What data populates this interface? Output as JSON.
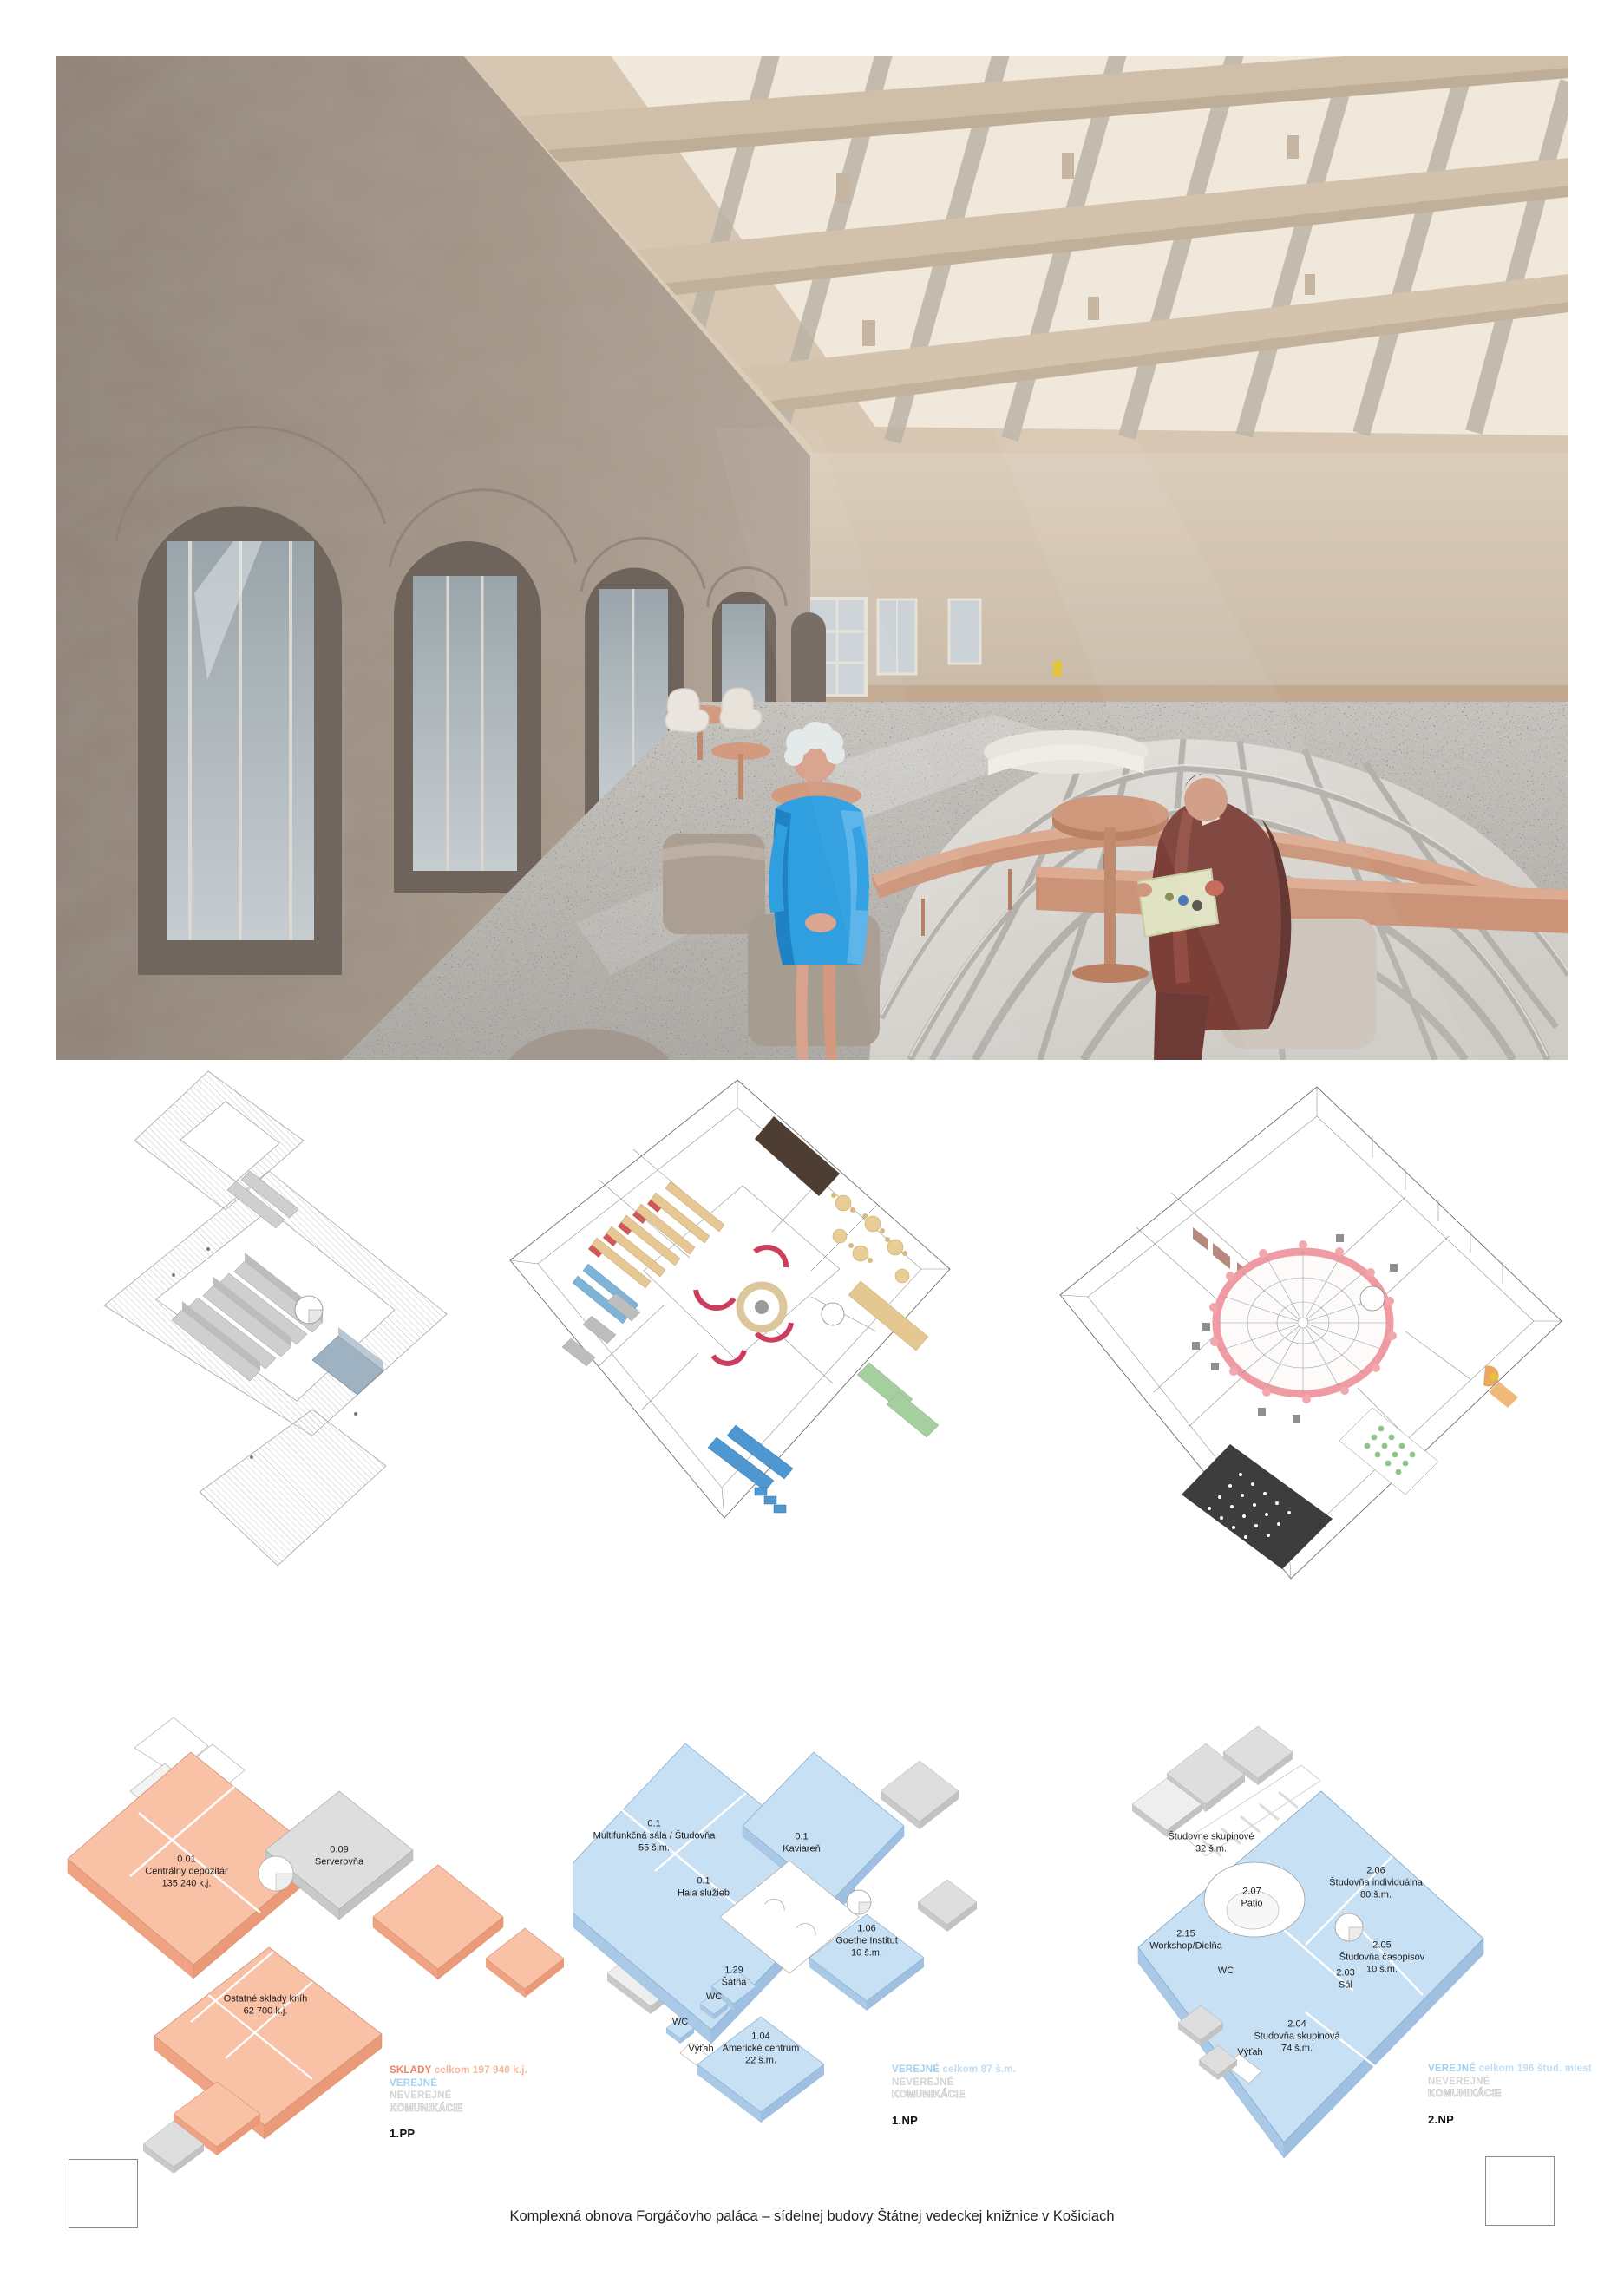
{
  "board": {
    "caption": "Komplexná obnova Forgáčovho paláca – sídelnej budovy Štátnej vedeckej knižnice v Košiciach"
  },
  "colors": {
    "storage_fill": "#f9c2a7",
    "storage_side": "#f0a382",
    "storage_text": "#ef8160",
    "public_fill": "#c8e0f4",
    "public_side": "#a9c9e6",
    "public_text": "#a5d0ee",
    "nonpublic_fill": "#dedede",
    "nonpublic_side": "#c9c9c9",
    "nonpublic_text": "#d4d4d4",
    "circulation_text": "#ffffff",
    "bench_accent": "#d39c82",
    "dome_ring_pink": "#ee9ba4"
  },
  "plans": {
    "pp1": {
      "floor": "1.PP",
      "legend": {
        "storage": "SKLADY",
        "storage_total": "celkom 197 940 k.j.",
        "public": "VEREJNÉ",
        "nonpublic": "NEVEREJNÉ",
        "circulation": "KOMUNIKÁCIE"
      },
      "rooms": {
        "depozitar": {
          "code": "0.01",
          "name": "Centrálny depozitár",
          "area": "135 240 k.j."
        },
        "serverovna": {
          "code": "0.09",
          "name": "Serverovňa"
        },
        "sklady": {
          "name": "Ostatné sklady kníh",
          "area": "62 700 k.j."
        }
      }
    },
    "np1": {
      "floor": "1.NP",
      "legend": {
        "public": "VEREJNÉ",
        "public_total": "celkom 87 š.m.",
        "nonpublic": "NEVEREJNÉ",
        "circulation": "KOMUNIKÁCIE"
      },
      "rooms": {
        "multifunkcna": {
          "code": "0.1",
          "name": "Multifunkčná sála / Študovňa",
          "area": "55 š.m."
        },
        "kaviaren": {
          "code": "0.1",
          "name": "Kaviareň"
        },
        "hala": {
          "code": "0.1",
          "name": "Hala služieb"
        },
        "goethe": {
          "code": "1.06",
          "name": "Goethe Institut",
          "area": "10 š.m."
        },
        "satna": {
          "code": "1.29",
          "name": "Šatňa"
        },
        "wc1": {
          "name": "WC"
        },
        "wc2": {
          "name": "WC"
        },
        "vytah": {
          "name": "Výťah"
        },
        "americke": {
          "code": "1.04",
          "name": "Americké centrum",
          "area": "22 š.m."
        }
      }
    },
    "np2": {
      "floor": "2.NP",
      "legend": {
        "public": "VEREJNÉ",
        "public_total": "celkom 196 štud. miest",
        "nonpublic": "NEVEREJNÉ",
        "circulation": "KOMUNIKÁCIE"
      },
      "rooms": {
        "skupinove": {
          "name": "Študovne skupinové",
          "area": "32 š.m."
        },
        "patio": {
          "code": "2.07",
          "name": "Patio"
        },
        "individualna": {
          "code": "2.06",
          "name": "Študovňa individuálna",
          "area": "80 š.m."
        },
        "workshop": {
          "code": "2.15",
          "name": "Workshop/Dielňa"
        },
        "wc": {
          "name": "WC"
        },
        "casopisy": {
          "code": "2.05",
          "name": "Študovňa časopisov",
          "area": "10 š.m."
        },
        "sal": {
          "code": "2.03",
          "name": "Sál"
        },
        "skupinova": {
          "code": "2.04",
          "name": "Študovňa skupinová",
          "area": "74 š.m."
        },
        "vytah": {
          "name": "Výťah"
        }
      }
    }
  }
}
